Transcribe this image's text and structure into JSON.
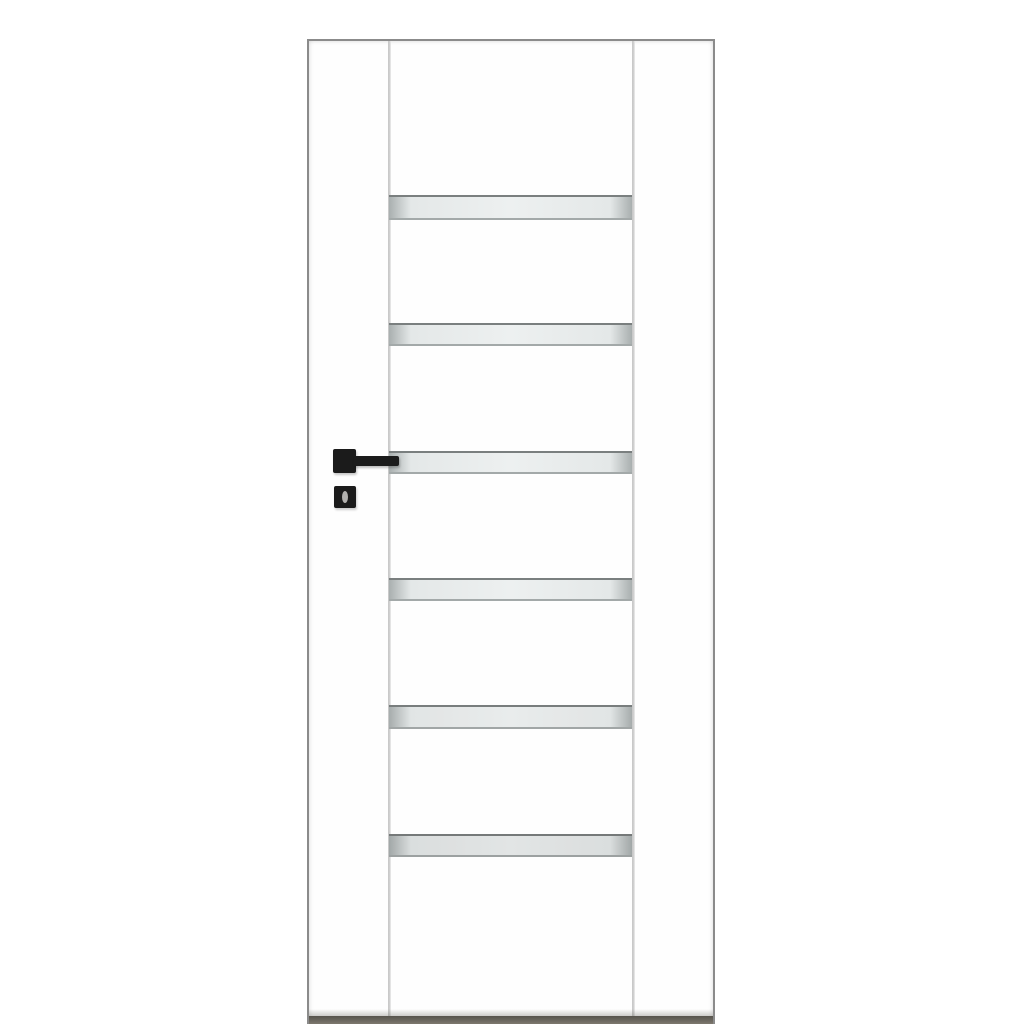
{
  "scene": {
    "type": "product-photo",
    "label": "White interior door leaf with six horizontal frosted glass strips and black square hardware",
    "background_color": "#ffffff"
  },
  "door": {
    "label": "white interior door leaf with vertical side stiles and glazed centre section",
    "glass": {
      "count": 6,
      "strip_label": "horizontal frosted glass strip"
    },
    "hardware": {
      "rosette_label": "black square handle rosette",
      "lever_label": "black square lever handle",
      "escutcheon_label": "black square key escutcheon",
      "keyhole_label": "keyhole"
    }
  },
  "colors": {
    "bg": "#ffffff",
    "door-face": "#fefefe",
    "door-edge": "#8b8b8b",
    "seam": "#c9c9c9",
    "seam-light": "#efefef",
    "glass-fill": "#e4e8e8",
    "glass-hi": "#edf0f0",
    "glass-end": "#a9afaf",
    "glass-border-top": "#7a7f7f",
    "glass-border-bottom": "#a3a9a9",
    "hardware": "#1b1b1b",
    "keyhole": "#b3b1af",
    "bottom-bar": "#6b675f",
    "bottom-bar-dark": "#57544d",
    "bottom-bar-light": "#7d786e"
  }
}
